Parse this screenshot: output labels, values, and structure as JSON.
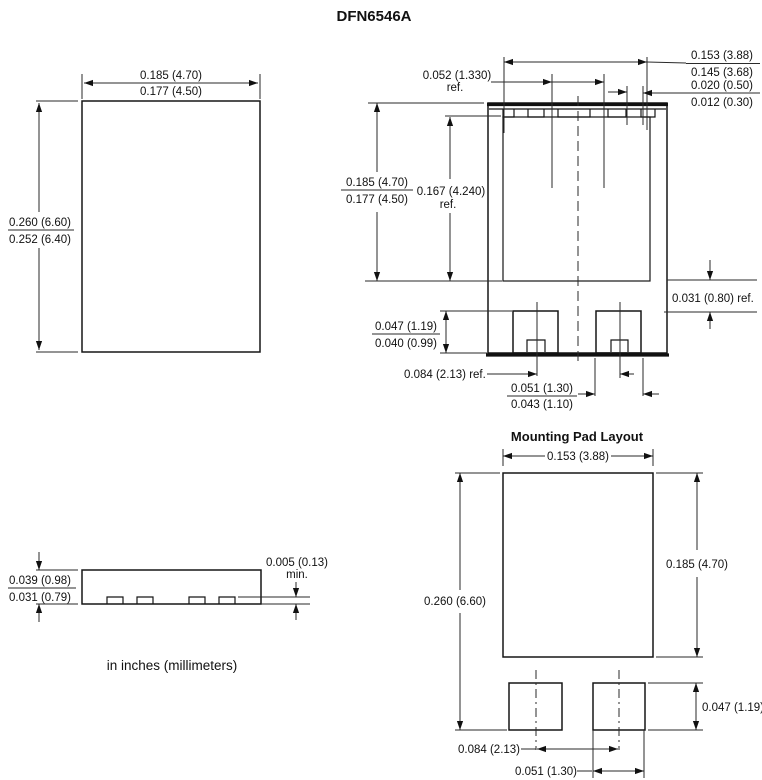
{
  "title": "DFN6546A",
  "caption": "in inches (millimeters)",
  "top_view": {
    "width_max": "0.185 (4.70)",
    "width_min": "0.177 (4.50)",
    "height_max": "0.260 (6.60)",
    "height_min": "0.252 (6.40)"
  },
  "bottom_view": {
    "pin_span_max": "0.153 (3.88)",
    "pin_span_min": "0.145 (3.68)",
    "pin_width_max": "0.020 (0.50)",
    "pin_width_min": "0.012 (0.30)",
    "pitch": "0.052 (1.330)",
    "pitch_ref": "ref.",
    "body_height_max": "0.185 (4.70)",
    "body_height_min": "0.177 (4.50)",
    "pad_height": "0.167 (4.240)",
    "pad_height_ref": "ref.",
    "pad_offset": "0.031 (0.80) ref.",
    "tab_height_max": "0.047 (1.19)",
    "tab_height_min": "0.040 (0.99)",
    "tab_spacing": "0.084 (2.13) ref.",
    "tab_width_max": "0.051 (1.30)",
    "tab_width_min": "0.043 (1.10)"
  },
  "side_view": {
    "thickness_max": "0.039 (0.98)",
    "thickness_min": "0.031 (0.79)",
    "standoff": "0.005 (0.13)",
    "standoff_min_label": "min."
  },
  "mounting_pad": {
    "title": "Mounting Pad Layout",
    "pad_width": "0.153 (3.88)",
    "total_height": "0.260 (6.60)",
    "pad_height": "0.185 (4.70)",
    "tab_height": "0.047 (1.19)",
    "tab_spacing": "0.084 (2.13)",
    "tab_width": "0.051 (1.30)"
  }
}
